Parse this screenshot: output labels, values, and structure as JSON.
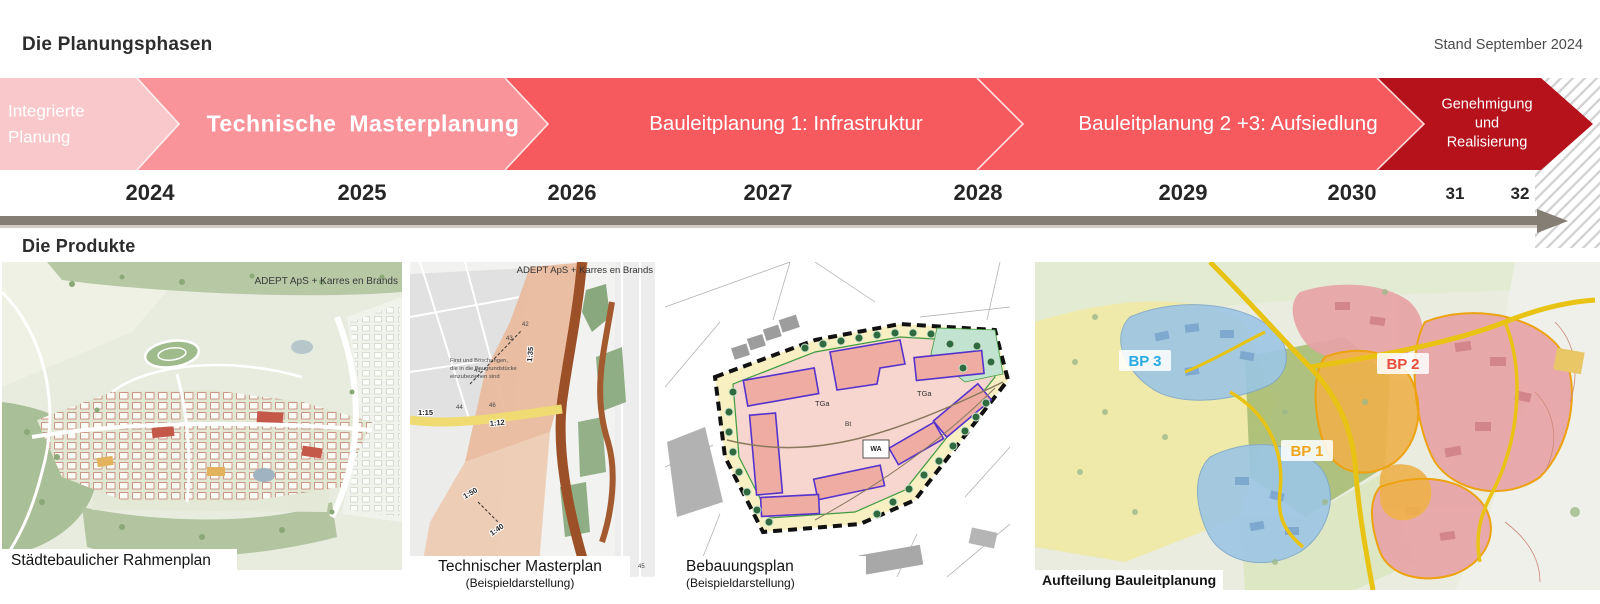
{
  "header": {
    "title": "Die Planungsphasen",
    "status_date": "Stand September 2024"
  },
  "phases": [
    {
      "label": "Integrierte Planung",
      "lines": [
        "Integrierte",
        "Planung"
      ],
      "color": "#f9c8cb",
      "start": "2024",
      "end": "2024"
    },
    {
      "label": "Technische Masterplanung",
      "color": "#f8949a",
      "start": "2024",
      "end": "2026"
    },
    {
      "label": "Bauleitplanung 1: Infrastruktur",
      "color": "#f65a5e",
      "start": "2026",
      "end": "2028"
    },
    {
      "label": "Bauleitplanung 2 +3: Aufsiedlung",
      "color": "#f65a5e",
      "start": "2028",
      "end": "2030"
    },
    {
      "label": "Genehmigung und Realisierung",
      "lines": [
        "Genehmigung",
        "und",
        "Realisierung"
      ],
      "color": "#b5121b",
      "start": "2030",
      "end": "2032"
    }
  ],
  "timeline": {
    "years": [
      "2024",
      "2025",
      "2026",
      "2027",
      "2028",
      "2029",
      "2030",
      "31",
      "32"
    ]
  },
  "products": {
    "heading": "Die Produkte",
    "items": [
      {
        "caption": "Städtebaulicher Rahmenplan",
        "credit": "ADEPT ApS + Karres en Brands"
      },
      {
        "caption": "Technischer Masterplan",
        "subcaption": "(Beispieldarstellung)",
        "credit": "ADEPT ApS + Karres en Brands",
        "note_lines": [
          "First und Böschungen,",
          "die in die Baugrundstücke",
          "einzubeziehen sind"
        ],
        "scale_labels": [
          "1:15",
          "1:12",
          "1:35",
          "1:50",
          "1:40"
        ],
        "elevation_labels": [
          "41",
          "42",
          "43",
          "44",
          "45",
          "46"
        ]
      },
      {
        "caption": "Bebauungsplan",
        "subcaption": "(Beispieldarstellung)",
        "zone_labels": [
          "TGa",
          "TGa",
          "WA",
          "Bt"
        ]
      },
      {
        "caption": "Aufteilung Bauleitplanung",
        "bp_labels": [
          {
            "text": "BP 3",
            "color": "#29abe2"
          },
          {
            "text": "BP 1",
            "color": "#f0a51f"
          },
          {
            "text": "BP 2",
            "color": "#e94f3f"
          }
        ]
      }
    ]
  }
}
